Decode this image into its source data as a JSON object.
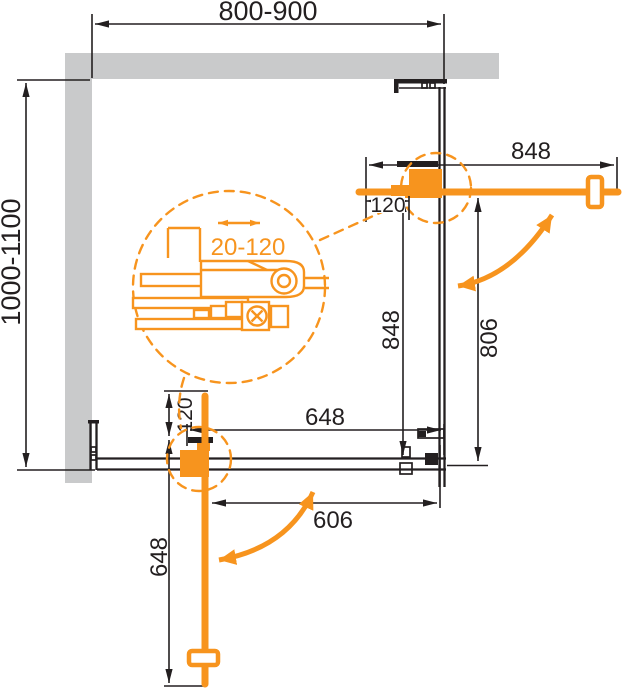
{
  "colors": {
    "accent": "#F7941E",
    "line": "#231F20",
    "wall": "#C9CACB",
    "background": "#FFFFFF"
  },
  "labels": {
    "top_width_range": "800-900",
    "left_depth_range": "1000-1100",
    "door_width": "848",
    "top_offset": "120",
    "side_height": "848",
    "side_opening": "806",
    "bottom_panel_width": "648",
    "bottom_offset": "120",
    "bottom_door_width": "648",
    "bottom_opening": "606",
    "detail_adjustment_range": "20-120"
  }
}
